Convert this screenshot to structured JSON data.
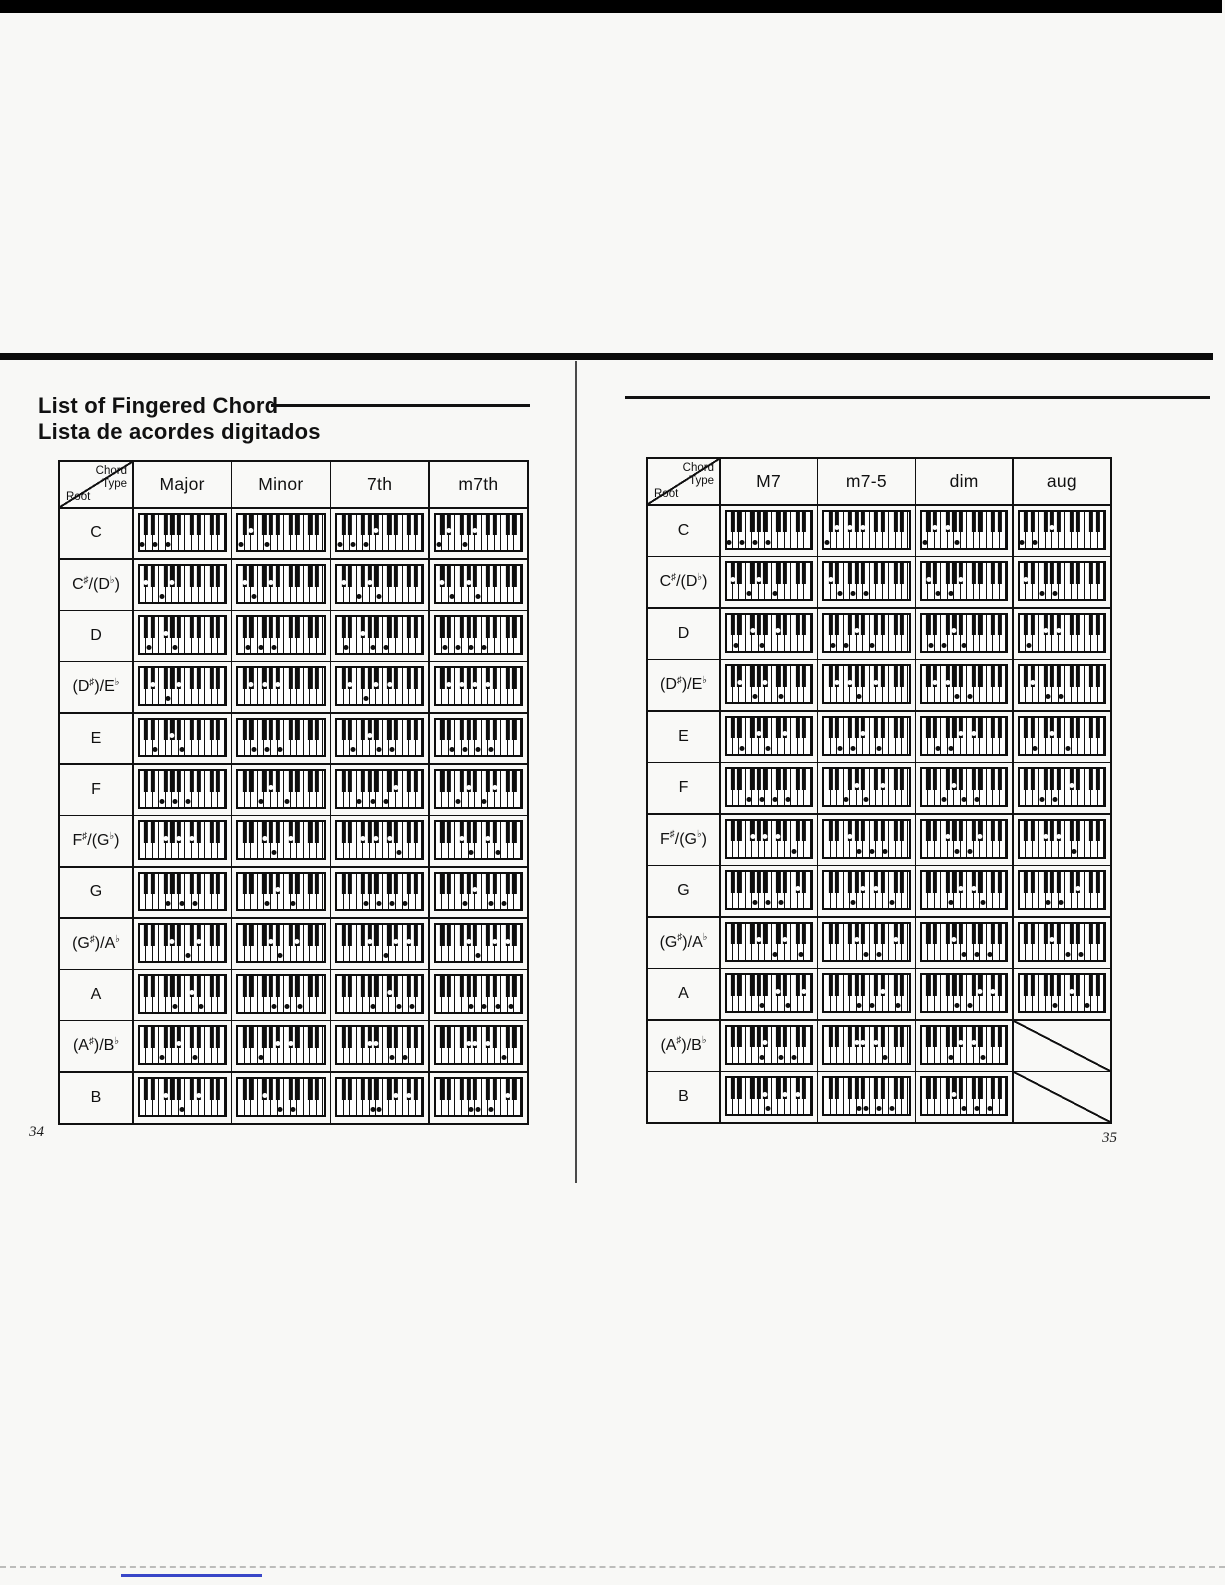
{
  "document": {
    "title_en": "List of Fingered Chord",
    "title_es": "Lista de acordes digitados",
    "corner_header": {
      "line1": "Chord",
      "line2": "Type",
      "root": "Root"
    },
    "keyboard_legend": {
      "white_keys": 13,
      "black_keys": 9,
      "lowest_note": "C",
      "pressed_white_key_marker": "black-dot",
      "pressed_black_key_marker": "white-dot"
    },
    "colors": {
      "ink": "#111111",
      "paper": "#f8f8f6",
      "bottom_line_blue": "#3947c8"
    },
    "left_page": {
      "page_number": "34",
      "columns": [
        "Major",
        "Minor",
        "7th",
        "m7th"
      ],
      "rows": [
        {
          "root": "C",
          "cells": [
            [
              0,
              4,
              7
            ],
            [
              0,
              3,
              7
            ],
            [
              0,
              4,
              7,
              10
            ],
            [
              0,
              3,
              7,
              10
            ]
          ]
        },
        {
          "root": "C♯/(D♭)",
          "cells": [
            [
              1,
              5,
              8
            ],
            [
              1,
              4,
              8
            ],
            [
              1,
              5,
              8,
              11
            ],
            [
              1,
              4,
              8,
              11
            ]
          ]
        },
        {
          "root": "D",
          "cells": [
            [
              2,
              6,
              9
            ],
            [
              2,
              5,
              9
            ],
            [
              2,
              6,
              9,
              12
            ],
            [
              2,
              5,
              9,
              12
            ]
          ]
        },
        {
          "root": "(D♯)/E♭",
          "cells": [
            [
              3,
              7,
              10
            ],
            [
              3,
              6,
              10
            ],
            [
              3,
              7,
              10,
              13
            ],
            [
              3,
              6,
              10,
              13
            ]
          ]
        },
        {
          "root": "E",
          "cells": [
            [
              4,
              8,
              11
            ],
            [
              4,
              7,
              11
            ],
            [
              4,
              8,
              11,
              14
            ],
            [
              4,
              7,
              11,
              14
            ]
          ]
        },
        {
          "root": "F",
          "cells": [
            [
              5,
              9,
              12
            ],
            [
              5,
              8,
              12
            ],
            [
              5,
              9,
              12,
              15
            ],
            [
              5,
              8,
              12,
              15
            ]
          ]
        },
        {
          "root": "F♯/(G♭)",
          "cells": [
            [
              6,
              10,
              13
            ],
            [
              6,
              9,
              13
            ],
            [
              6,
              10,
              13,
              16
            ],
            [
              6,
              9,
              13,
              16
            ]
          ]
        },
        {
          "root": "G",
          "cells": [
            [
              7,
              11,
              14
            ],
            [
              7,
              10,
              14
            ],
            [
              7,
              11,
              14,
              17
            ],
            [
              7,
              10,
              14,
              17
            ]
          ]
        },
        {
          "root": "(G♯)/A♭",
          "cells": [
            [
              8,
              12,
              15
            ],
            [
              8,
              11,
              15
            ],
            [
              8,
              12,
              15,
              18
            ],
            [
              8,
              11,
              15,
              18
            ]
          ]
        },
        {
          "root": "A",
          "cells": [
            [
              9,
              13,
              16
            ],
            [
              9,
              12,
              16
            ],
            [
              9,
              13,
              16,
              19
            ],
            [
              9,
              12,
              16,
              19
            ]
          ]
        },
        {
          "root": "(A♯)/B♭",
          "cells": [
            [
              5,
              10,
              14
            ],
            [
              5,
              10,
              13
            ],
            [
              8,
              10,
              14,
              17
            ],
            [
              8,
              10,
              13,
              17
            ]
          ]
        },
        {
          "root": "B",
          "cells": [
            [
              6,
              11,
              15
            ],
            [
              6,
              11,
              14
            ],
            [
              9,
              11,
              15,
              18
            ],
            [
              9,
              11,
              14,
              18
            ]
          ]
        }
      ]
    },
    "right_page": {
      "page_number": "35",
      "columns": [
        "M7",
        "m7-5",
        "dim",
        "aug"
      ],
      "rows": [
        {
          "root": "C",
          "cells": [
            [
              0,
              4,
              7,
              11
            ],
            [
              0,
              3,
              6,
              10
            ],
            [
              0,
              3,
              6,
              9
            ],
            [
              0,
              4,
              8
            ]
          ]
        },
        {
          "root": "C♯/(D♭)",
          "cells": [
            [
              1,
              5,
              8,
              12
            ],
            [
              1,
              4,
              7,
              11
            ],
            [
              1,
              4,
              7,
              10
            ],
            [
              1,
              5,
              9
            ]
          ]
        },
        {
          "root": "D",
          "cells": [
            [
              2,
              6,
              9,
              13
            ],
            [
              2,
              5,
              8,
              12
            ],
            [
              2,
              5,
              8,
              11
            ],
            [
              2,
              6,
              10
            ]
          ]
        },
        {
          "root": "(D♯)/E♭",
          "cells": [
            [
              3,
              7,
              10,
              14
            ],
            [
              3,
              6,
              9,
              13
            ],
            [
              3,
              6,
              9,
              12
            ],
            [
              3,
              7,
              11
            ]
          ]
        },
        {
          "root": "E",
          "cells": [
            [
              4,
              8,
              11,
              15
            ],
            [
              4,
              7,
              10,
              14
            ],
            [
              4,
              7,
              10,
              13
            ],
            [
              4,
              8,
              12
            ]
          ]
        },
        {
          "root": "F",
          "cells": [
            [
              5,
              9,
              12,
              16
            ],
            [
              5,
              8,
              11,
              15
            ],
            [
              5,
              8,
              11,
              14
            ],
            [
              5,
              9,
              13
            ]
          ]
        },
        {
          "root": "F♯/(G♭)",
          "cells": [
            [
              6,
              10,
              13,
              17
            ],
            [
              6,
              9,
              12,
              16
            ],
            [
              6,
              9,
              12,
              15
            ],
            [
              6,
              10,
              14
            ]
          ]
        },
        {
          "root": "G",
          "cells": [
            [
              7,
              11,
              14,
              18
            ],
            [
              7,
              10,
              13,
              17
            ],
            [
              7,
              10,
              13,
              16
            ],
            [
              7,
              11,
              15
            ]
          ]
        },
        {
          "root": "(G♯)/A♭",
          "cells": [
            [
              8,
              12,
              15,
              19
            ],
            [
              8,
              11,
              14,
              18
            ],
            [
              8,
              11,
              14,
              17
            ],
            [
              8,
              12,
              16
            ]
          ]
        },
        {
          "root": "A",
          "cells": [
            [
              9,
              13,
              16,
              20
            ],
            [
              9,
              12,
              15,
              19
            ],
            [
              9,
              12,
              15,
              18
            ],
            [
              9,
              13,
              17
            ]
          ]
        },
        {
          "root": "(A♯)/B♭",
          "cells": [
            [
              9,
              10,
              14,
              17
            ],
            [
              8,
              10,
              13,
              16
            ],
            [
              7,
              10,
              13,
              16
            ],
            null
          ]
        },
        {
          "root": "B",
          "cells": [
            [
              10,
              11,
              15,
              18
            ],
            [
              9,
              11,
              14,
              17
            ],
            [
              8,
              11,
              14,
              17
            ],
            null
          ]
        }
      ]
    }
  }
}
